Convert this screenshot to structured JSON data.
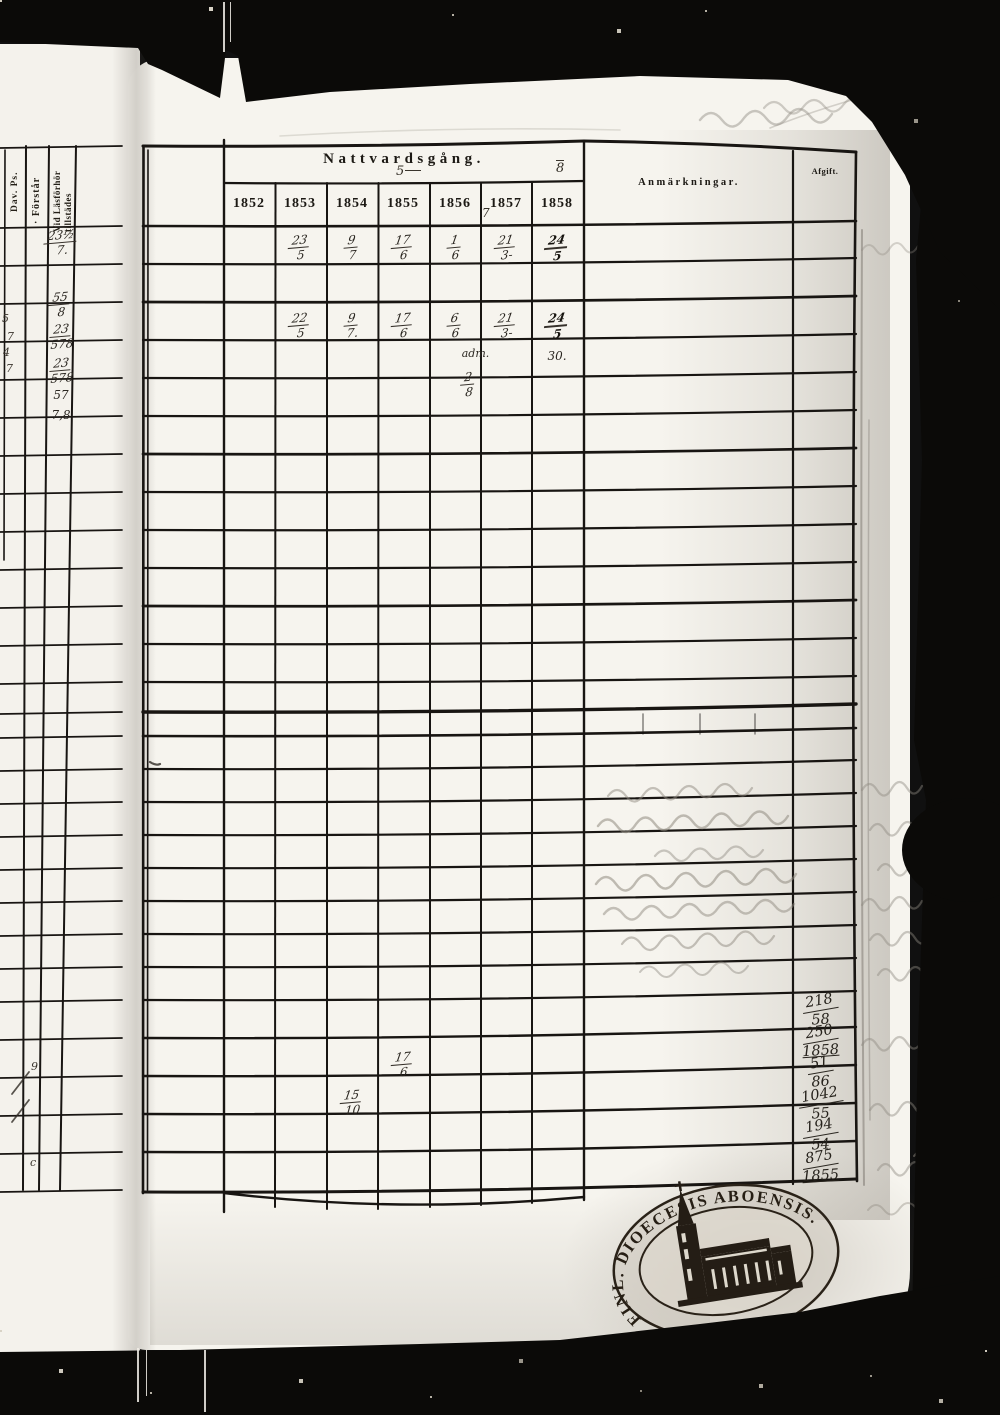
{
  "document": {
    "title": "Nattvardsgång.",
    "remarks_header": "Anmärkningar.",
    "fee_header": "Afgift.",
    "years": [
      "1852",
      "1853",
      "1854",
      "1855",
      "1856",
      "1857",
      "1858"
    ],
    "annotations": {
      "above_title": "5",
      "above_title_right": "8",
      "under_1857": "7"
    }
  },
  "left_page": {
    "col_header_dav": "Dav. Ps.",
    "col_header_forstar": "· Förstår",
    "col_header_vid_line1": "Vid Läsförhör",
    "col_header_vid_line2": "tillstädes",
    "scraps": [
      {
        "top": "23½",
        "bottom": "7."
      },
      {
        "top": "55",
        "bottom": "8"
      },
      {
        "top": "23",
        "bottom": "578"
      },
      {
        "top": "23",
        "bottom": "578"
      },
      {
        "text": "57"
      },
      {
        "text": "7,8"
      }
    ],
    "margin_marks": [
      "5",
      "7",
      "4",
      "7",
      "9",
      "c"
    ]
  },
  "communion": {
    "entries": [
      {
        "pos": "r1",
        "year": "1853",
        "num": "23",
        "den": "5"
      },
      {
        "pos": "r1",
        "year": "1854",
        "num": "9",
        "den": "7"
      },
      {
        "pos": "r1",
        "year": "1855",
        "num": "17",
        "den": "6"
      },
      {
        "pos": "r1",
        "year": "1856",
        "num": "1",
        "den": "6"
      },
      {
        "pos": "r1",
        "year": "1857",
        "num": "21",
        "den": "3-"
      },
      {
        "pos": "r1",
        "year": "1858",
        "num": "24",
        "den": "5",
        "bold": true
      },
      {
        "pos": "r3",
        "year": "1853",
        "num": "22",
        "den": "5"
      },
      {
        "pos": "r3",
        "year": "1854",
        "num": "9",
        "den": "7."
      },
      {
        "pos": "r3",
        "year": "1855",
        "num": "17",
        "den": "6"
      },
      {
        "pos": "r3",
        "year": "1856",
        "num": "6",
        "den": "6"
      },
      {
        "pos": "r3",
        "year": "1857",
        "num": "21",
        "den": "3-"
      },
      {
        "pos": "r3",
        "year": "1858",
        "num": "24",
        "den": "5",
        "bold": true
      },
      {
        "pos": "r4",
        "year": "1856",
        "prefix": "adm.",
        "num": "2",
        "den": "8",
        "dx": 22
      },
      {
        "pos": "r4",
        "year": "1858",
        "text": "30."
      },
      {
        "pos": "rb1",
        "year": "1855",
        "num": "17",
        "den": "6"
      },
      {
        "pos": "rb2",
        "year": "1854",
        "num": "15",
        "den": "10"
      }
    ]
  },
  "fee_sums": [
    {
      "top": "218",
      "bottom": "58"
    },
    {
      "top": "250",
      "bottom": "1858",
      "underline": true
    },
    {
      "top": "51",
      "bottom": "86"
    },
    {
      "top": "1042",
      "bottom": "55"
    },
    {
      "top": "194",
      "bottom": "54"
    },
    {
      "top": "875",
      "bottom": "1855",
      "underline": true
    }
  ],
  "stamp": {
    "ring_main": "FINL. DIOECESIS ABOENSIS.",
    "ring_bottom": "MAGNI PR."
  }
}
